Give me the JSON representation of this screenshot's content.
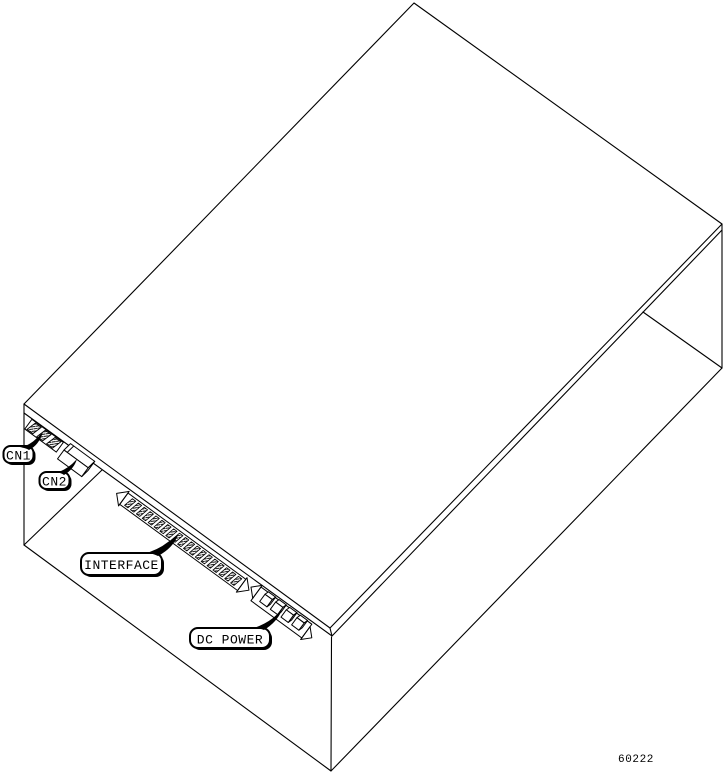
{
  "figure": {
    "number": "60222",
    "description": "Isometric line drawing of a unit enclosure showing bottom-edge connectors"
  },
  "callouts": [
    {
      "id": "cn1",
      "label": "CN1"
    },
    {
      "id": "cn2",
      "label": "CN2"
    },
    {
      "id": "interface",
      "label": "INTERFACE"
    },
    {
      "id": "dc_power",
      "label": "DC POWER"
    }
  ],
  "connectors": {
    "cn1_pin_count": 3,
    "interface_pin_count": 19,
    "dc_power_pin_count": 4
  },
  "colors": {
    "line": "#000000",
    "background": "#ffffff"
  }
}
